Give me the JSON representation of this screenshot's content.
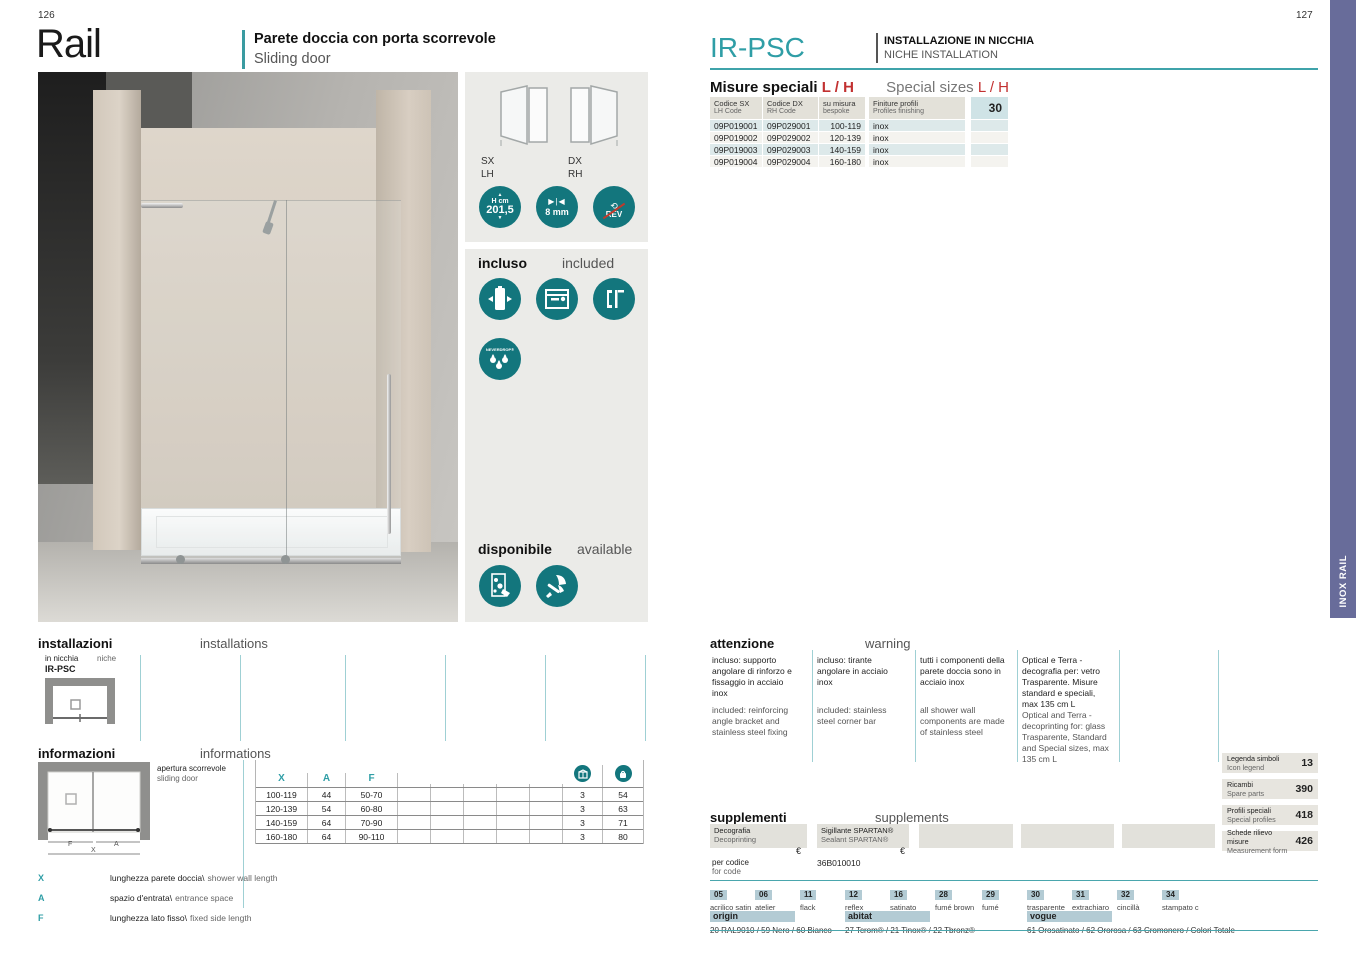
{
  "colors": {
    "teal_accent": "#2f9ea6",
    "teal_icon": "#13767d",
    "red_accent": "#c23131",
    "sidebar_purple": "#686c9a",
    "panel_gray": "#ebebe8",
    "badge_blue": "#b3cbd4"
  },
  "left": {
    "page_number": "126",
    "title": "Rail",
    "subtitle_it": "Parete doccia con porta scorrevole",
    "subtitle_en": "Sliding door",
    "panel": {
      "sx": "SX",
      "lh": "LH",
      "dx": "DX",
      "rh": "RH",
      "height_icon_line1": "H cm",
      "height_icon_line2": "201,5",
      "glass_icon": "8 mm",
      "rev_icon": "REV",
      "included_it": "incluso",
      "included_en": "included",
      "neverdrop": "NEVERDROP®",
      "available_it": "disponibile",
      "available_en": "available"
    },
    "installations": {
      "title_it": "installazioni",
      "title_en": "installations",
      "type_it": "in nicchia",
      "type_en": "niche",
      "code": "IR-PSC"
    },
    "informations": {
      "title_it": "informazioni",
      "title_en": "informations",
      "opening_it": "apertura scorrevole",
      "opening_en": "sliding door",
      "dim_f": "F",
      "dim_a": "A",
      "dim_x": "X",
      "table_headers": [
        "X",
        "A",
        "F"
      ],
      "rows": [
        {
          "x": "100-119",
          "a": "44",
          "f": "50-70",
          "pieces": "3",
          "weight": "54"
        },
        {
          "x": "120-139",
          "a": "54",
          "f": "60-80",
          "pieces": "3",
          "weight": "63"
        },
        {
          "x": "140-159",
          "a": "64",
          "f": "70-90",
          "pieces": "3",
          "weight": "71"
        },
        {
          "x": "160-180",
          "a": "64",
          "f": "90-110",
          "pieces": "3",
          "weight": "80"
        }
      ],
      "legend": [
        {
          "key": "X",
          "it": "lunghezza parete doccia\\",
          "en": "shower wall length"
        },
        {
          "key": "A",
          "it": "spazio d'entrata\\",
          "en": "entrance space"
        },
        {
          "key": "F",
          "it": "lunghezza lato fisso\\",
          "en": "fixed side length"
        }
      ]
    }
  },
  "right": {
    "page_number": "127",
    "code": "IR-PSC",
    "installation_it": "INSTALLAZIONE IN NICCHIA",
    "installation_en": "NICHE INSTALLATION",
    "special_sizes": {
      "title_it": "Misure speciali",
      "accent_it": "L / H",
      "title_en": "Special sizes",
      "accent_en": "L / H",
      "headers": {
        "c1_it": "Codice SX",
        "c1_en": "LH Code",
        "c2_it": "Codice DX",
        "c2_en": "RH Code",
        "c3_it": "su misura",
        "c3_en": "bespoke",
        "c4_it": "Finiture profili",
        "c4_en": "Profiles finishing",
        "c5": "30"
      },
      "rows": [
        {
          "sx": "09P019001",
          "dx": "09P029001",
          "size": "100-119",
          "finish": "inox"
        },
        {
          "sx": "09P019002",
          "dx": "09P029002",
          "size": "120-139",
          "finish": "inox"
        },
        {
          "sx": "09P019003",
          "dx": "09P029003",
          "size": "140-159",
          "finish": "inox"
        },
        {
          "sx": "09P019004",
          "dx": "09P029004",
          "size": "160-180",
          "finish": "inox"
        }
      ]
    },
    "warning": {
      "title_it": "attenzione",
      "title_en": "warning",
      "columns": [
        {
          "it": "incluso: supporto angolare di rinforzo e fissaggio in acciaio inox",
          "en": "included: reinforcing angle bracket and stainless steel fixing"
        },
        {
          "it": "incluso: tirante angolare in acciaio inox",
          "en": "included: stainless steel corner bar"
        },
        {
          "it": "tutti i componenti della parete doccia sono in acciaio inox",
          "en": "all shower wall components are made of stainless steel"
        },
        {
          "it": "Optical e Terra - decografia per: vetro Trasparente. Misure standard e speciali, max 135 cm L",
          "en": "Optical and Terra - decoprinting for: glass Trasparente, Standard and Special sizes, max 135 cm L"
        }
      ]
    },
    "supplements": {
      "title_it": "supplementi",
      "title_en": "supplements",
      "box1_it": "Decografia",
      "box1_en": "Decoprinting",
      "box2_it": "Sigillante SPARTAN®",
      "box2_en": "Sealant SPARTAN®",
      "currency": "€",
      "per_code_it": "per codice",
      "per_code_en": "for code",
      "code_value": "36B010010"
    },
    "finishes": {
      "codes": [
        {
          "code": "05",
          "label": "acrilico satin"
        },
        {
          "code": "06",
          "label": "atelier"
        },
        {
          "code": "11",
          "label": "flack"
        },
        {
          "code": "12",
          "label": "reflex"
        },
        {
          "code": "16",
          "label": "satinato"
        },
        {
          "code": "28",
          "label": "fumé brown"
        },
        {
          "code": "29",
          "label": "fumé"
        },
        {
          "code": "30",
          "label": "trasparente"
        },
        {
          "code": "31",
          "label": "extrachiaro"
        },
        {
          "code": "32",
          "label": "cincillà"
        },
        {
          "code": "34",
          "label": "stampato c"
        }
      ],
      "groups": [
        {
          "name": "origin",
          "colors": "20 RAL9010 / 59 Nero / 60 Bianco"
        },
        {
          "name": "abitat",
          "colors": "27 Tcrom® / 21 Tinox® / 22 Tbronz®"
        },
        {
          "name": "vogue",
          "colors": "61 Orosatinato / 62 Ororosa / 63 Cromonero / Colori Totale"
        }
      ]
    },
    "references": [
      {
        "it": "Legenda simboli",
        "en": "Icon legend",
        "page": "13"
      },
      {
        "it": "Ricambi",
        "en": "Spare parts",
        "page": "390"
      },
      {
        "it": "Profili speciali",
        "en": "Special profiles",
        "page": "418"
      },
      {
        "it": "Schede rilievo misure",
        "en": "Measurement form",
        "page": "426"
      }
    ],
    "sidebar_label": "INOX RAIL"
  }
}
